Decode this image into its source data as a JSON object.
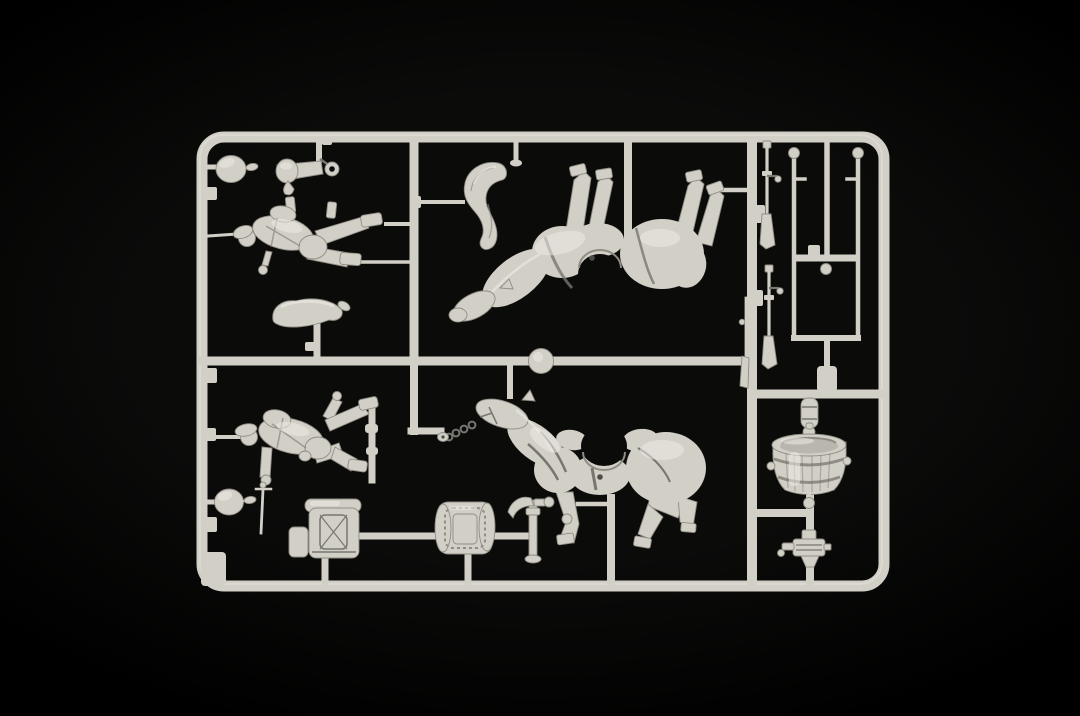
{
  "meta": {
    "description": "Photograph of an unassembled light-grey polystyrene model kit sprue (cavalry / horse-team figure set) lying on a black background",
    "scene_type": "model-kit-sprue-photo",
    "visible_text": ""
  },
  "colors": {
    "background": "#0b0b0a",
    "background_edge": "#000000",
    "plastic": "#d2cfc6",
    "plastic_highlight": "#edebe5",
    "plastic_mid": "#b9b6ad",
    "plastic_shadow": "#8f8c84",
    "plastic_outline": "#787670",
    "plastic_deep": "#4e4c47"
  },
  "sprue": {
    "frame_label": "rectangular sprue frame with rounded corners and internal runners",
    "parts": {
      "helmet_ball_top": {
        "label": "round helmet ball part, top left"
      },
      "arm_piece": {
        "label": "bent arm part with curled hand"
      },
      "lying_rider": {
        "label": "rider figure moulded horizontally"
      },
      "curved_arm": {
        "label": "curved arm part on short post"
      },
      "horse_tail": {
        "label": "wavy horse tail plume"
      },
      "horse_half_top": {
        "label": "horse body half, upside down, legs up"
      },
      "sprue_disc": {
        "label": "round moulding disc on centre runner"
      },
      "chain": {
        "label": "halter chain with toggle ring"
      },
      "horse_half_bottom": {
        "label": "standing horse body half with harness"
      },
      "rifle_1": {
        "label": "rifle with bolt, upper"
      },
      "rifle_2": {
        "label": "rifle with bolt, lower"
      },
      "rifle_3": {
        "label": "rifle on inner side of runner"
      },
      "rod_fork": {
        "label": "two rods with ball finials on U-shaped runner"
      },
      "canteen_cylinder": {
        "label": "small cylinder part on runner"
      },
      "water_barrel": {
        "label": "wooden water tub with staves and hoops"
      },
      "gun_mount": {
        "label": "small gun / pump mount part"
      },
      "marching_soldier": {
        "label": "walking soldier figure"
      },
      "sword": {
        "label": "hanging arm with sabre"
      },
      "helmet_ball_bottom": {
        "label": "round helmet ball part, bottom left"
      },
      "backpack": {
        "label": "large backpack with blanket roll and side pouch"
      },
      "saddlebag": {
        "label": "quilted saddle pack"
      },
      "pick_tool": {
        "label": "pick / entrenching tool"
      }
    }
  }
}
